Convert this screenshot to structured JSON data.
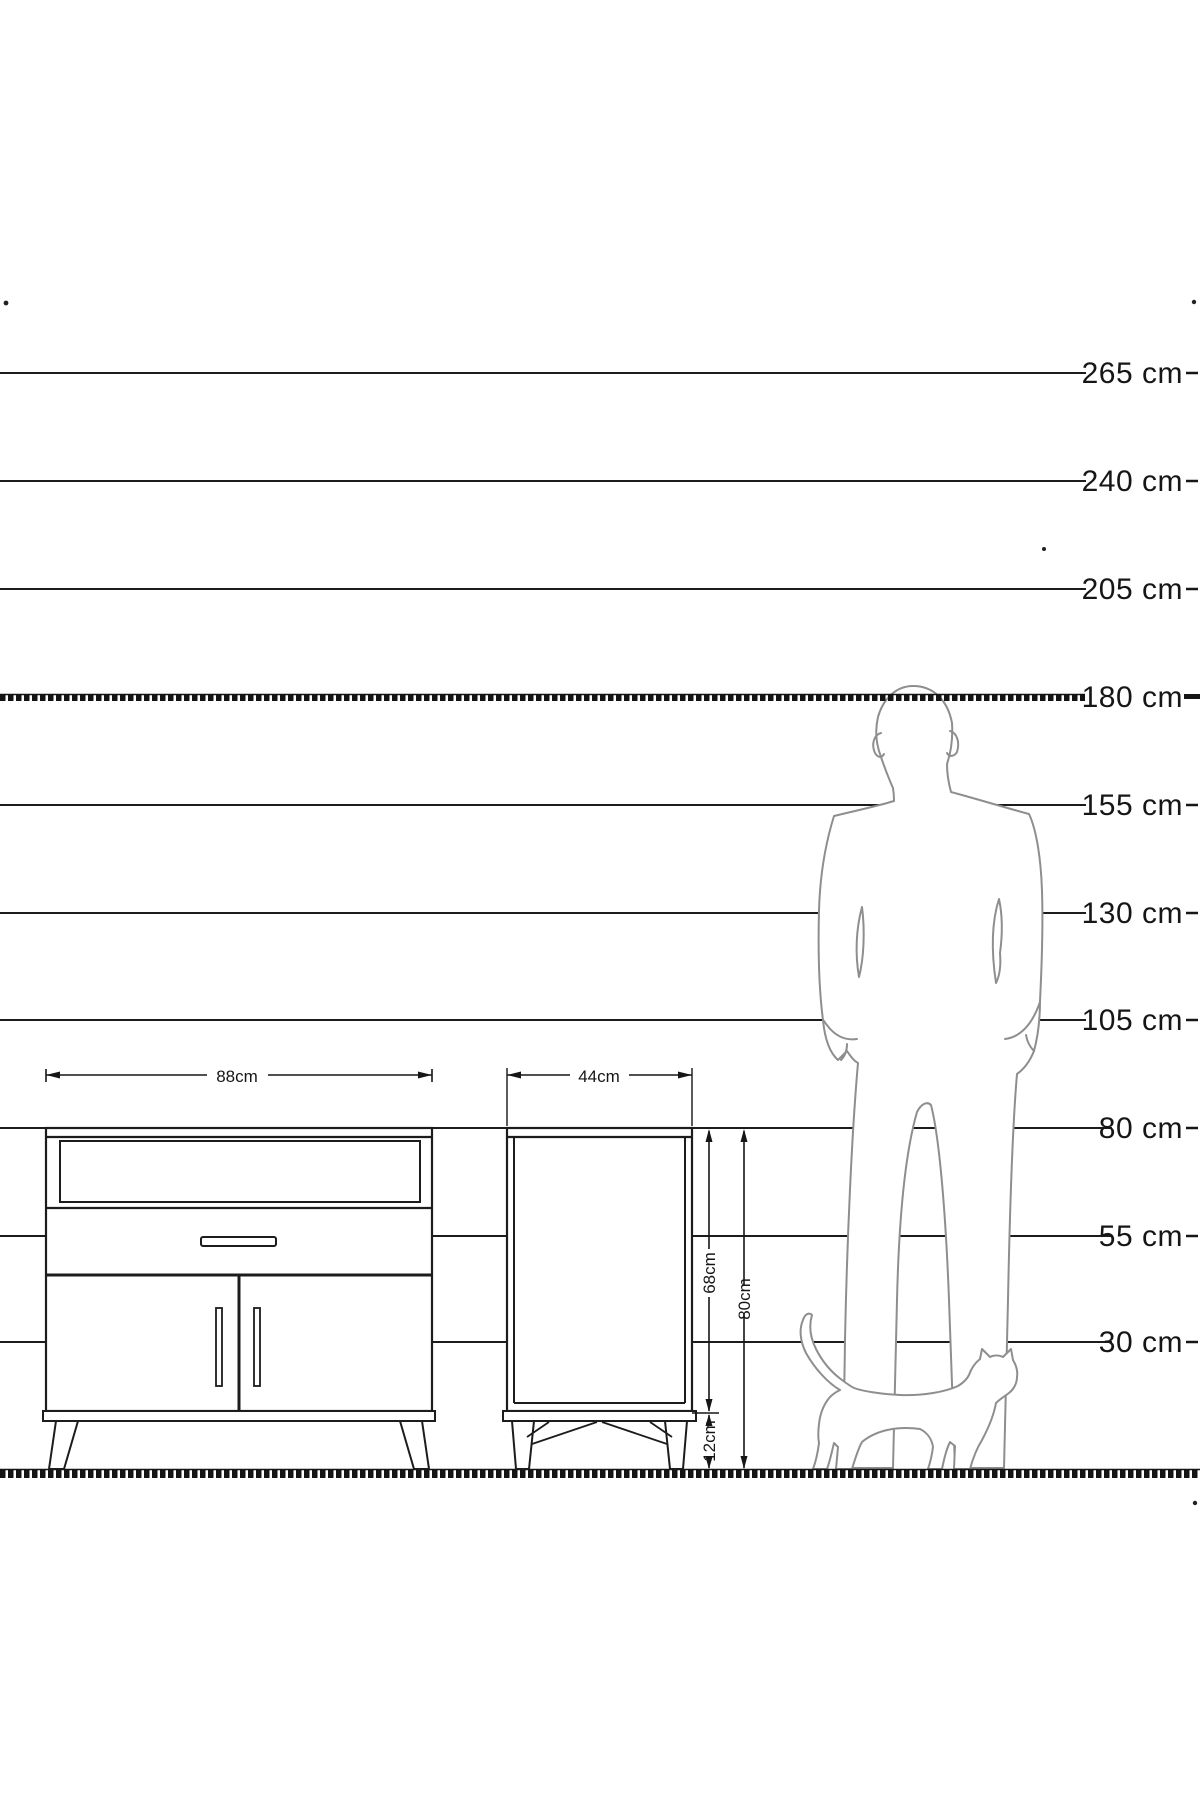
{
  "scale": {
    "unit": "cm",
    "labels": [
      {
        "value": 265,
        "text": "265 cm"
      },
      {
        "value": 240,
        "text": "240 cm"
      },
      {
        "value": 205,
        "text": "205 cm"
      },
      {
        "value": 180,
        "text": "180 cm",
        "emphasized": true
      },
      {
        "value": 155,
        "text": "155 cm"
      },
      {
        "value": 130,
        "text": "130 cm"
      },
      {
        "value": 105,
        "text": "105 cm"
      },
      {
        "value": 80,
        "text": "80 cm"
      },
      {
        "value": 55,
        "text": "55 cm"
      },
      {
        "value": 30,
        "text": "30 cm"
      }
    ]
  },
  "dimensions": {
    "sideboard_width": "88cm",
    "cabinet_width": "44cm",
    "cabinet_body_height": "68cm",
    "cabinet_total_height": "80cm",
    "cabinet_leg_height": "12cm"
  },
  "colors": {
    "line": "#1c1c1c",
    "silhouette": "#8e8e8e",
    "background": "#ffffff"
  }
}
